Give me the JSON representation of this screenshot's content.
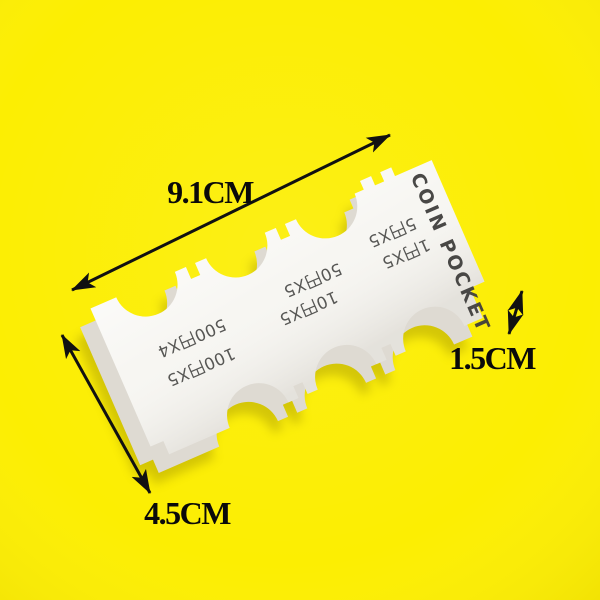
{
  "background": {
    "color": "#FCEE02"
  },
  "product": {
    "title": "COIN POCKET",
    "body_color": "#F7F6F2",
    "side_color": "#DEDAD2",
    "label_color": "#4A4A48",
    "title_color": "#403F3D",
    "pocket_labels": [
      {
        "line1": "500円X4",
        "line2": "100円X5"
      },
      {
        "line1": "50円X5",
        "line2": "10円X5"
      },
      {
        "line1": "5円X5",
        "line2": "1円X5"
      }
    ]
  },
  "dimensions": {
    "length_label": "9.1CM",
    "width_label": "4.5CM",
    "thickness_label": "1.5CM",
    "line_color": "#111111",
    "text_color": "#0A0A0A"
  }
}
